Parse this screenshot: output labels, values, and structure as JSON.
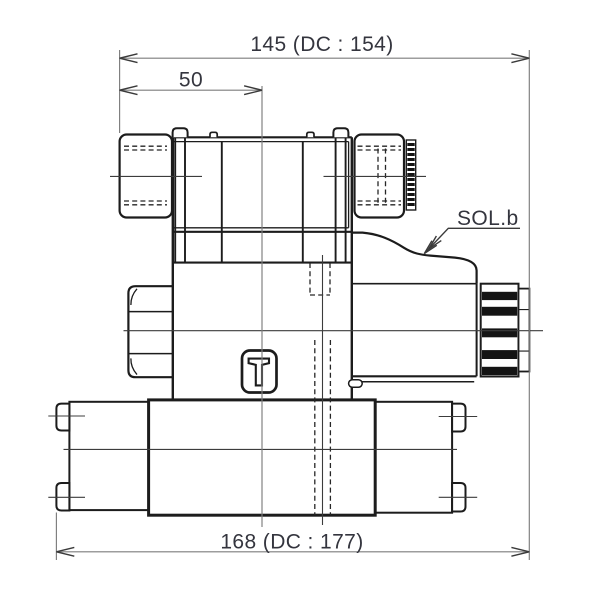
{
  "meta": {
    "description": "Technical side-view drawing of a single-solenoid directional control valve mounted on a base plate",
    "background": "#ffffff"
  },
  "colors": {
    "outline": "#1c1c1c",
    "dimension_line": "#7d7d7d",
    "arrow": "#3a3a3a",
    "hidden_line": "#262626",
    "text": "#34353e"
  },
  "dimensions": {
    "top_overall": "145 (DC : 154)",
    "top_sub": "50",
    "bottom_overall": "168 (DC : 177)"
  },
  "labels": {
    "solenoid_b": "SOL.b"
  }
}
